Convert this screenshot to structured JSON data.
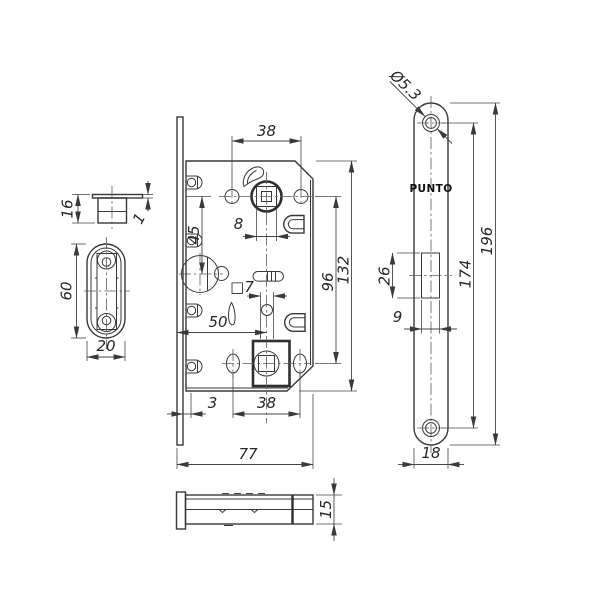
{
  "brand": "PUNTO",
  "dims": {
    "strike_height": "16",
    "strike_flange": "1",
    "strike_length": "60",
    "strike_width": "20",
    "top_hole_spacing": "38",
    "hub_to_cylinder": "45",
    "handle_square": "8",
    "hub_distance": "96",
    "case_height": "132",
    "wc_square": "□7",
    "backset": "50",
    "faceplate_stand": "3",
    "bottom_hole_spacing": "38",
    "case_depth": "77",
    "case_thickness": "15",
    "screw_hole_dia": "Ø5.3",
    "latch_height": "26",
    "latch_width": "9",
    "screw_spacing": "174",
    "faceplate_length": "196",
    "faceplate_width": "18"
  }
}
